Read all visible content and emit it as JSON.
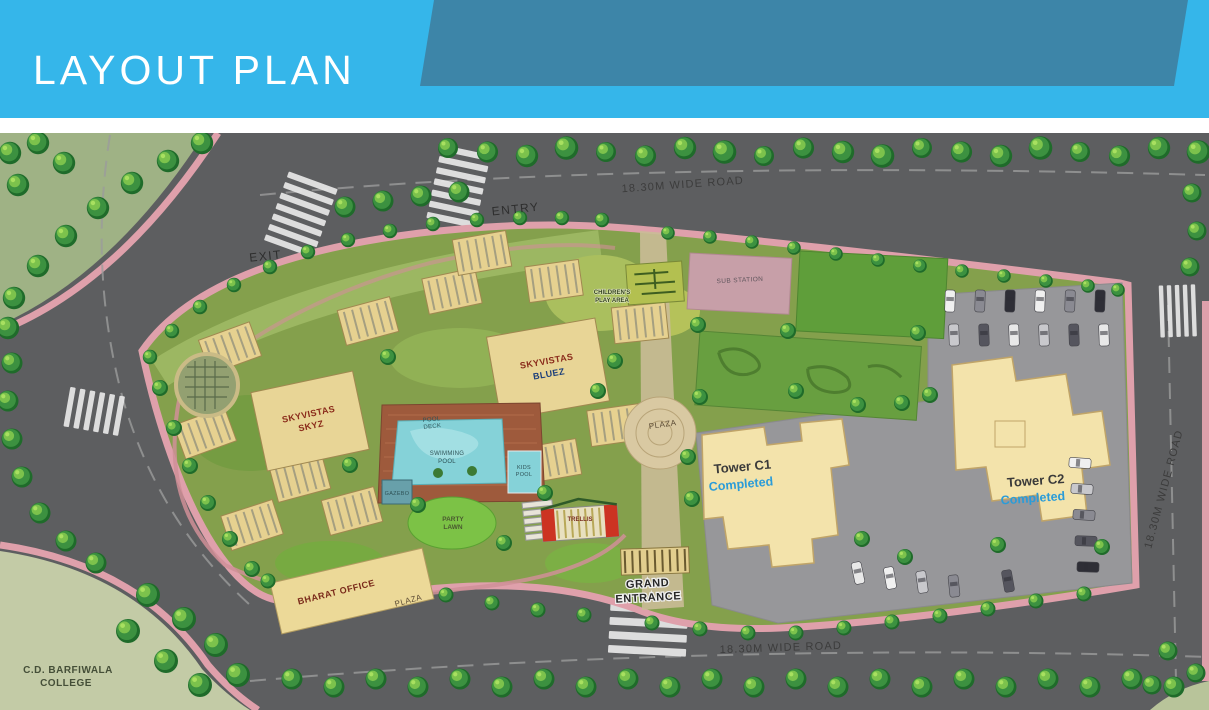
{
  "header": {
    "title": "LAYOUT PLAN",
    "band_color": "#35b6ea",
    "accent_color": "#3d85a8",
    "text_color": "#ffffff"
  },
  "plan": {
    "roads": {
      "top_label": "18.30M WIDE ROAD",
      "bottom_label": "18.30M WIDE ROAD",
      "right_label": "18.30M WIDE ROAD"
    },
    "access": {
      "entry": "ENTRY",
      "exit": "EXIT",
      "grand_entrance_line1": "GRAND",
      "grand_entrance_line2": "ENTRANCE"
    },
    "buildings": {
      "skyz": {
        "line1": "SKYVISTAS",
        "line2": "SKYZ"
      },
      "bluez": {
        "line1": "SKYVISTAS",
        "line2": "BLUEZ"
      },
      "tower_c1": {
        "name": "Tower C1",
        "status": "Completed"
      },
      "tower_c2": {
        "name": "Tower C2",
        "status": "Completed"
      },
      "bharat_office": "BHARAT OFFICE"
    },
    "amenities": {
      "pool_deck": {
        "line1": "POOL",
        "line2": "DECK"
      },
      "swimming_pool": {
        "line1": "SWIMMING",
        "line2": "POOL"
      },
      "kids_pool": {
        "line1": "KIDS",
        "line2": "POOL"
      },
      "gazebo": "GAZEBO",
      "party_lawn": {
        "line1": "PARTY",
        "line2": "LAWN"
      },
      "trellis": "TRELLIS",
      "plaza_center": "PLAZA",
      "plaza_south": "PLAZA",
      "children_play_area": {
        "line1": "CHILDREN'S",
        "line2": "PLAY AREA"
      },
      "sub_station": "SUB STATION"
    },
    "landmarks": {
      "college_line1": "C.D. BARFIWALA",
      "college_line2": "COLLEGE"
    },
    "colors": {
      "road_grey": "#5d5e60",
      "parcel_green": "#84a04c",
      "boundary_pink": "#dfa0ab",
      "building_tan": "#e8d596",
      "tower_yellow": "#f3e3ab",
      "pool_blue": "#85d2d8",
      "completed_blue": "#2b9cd8"
    }
  }
}
